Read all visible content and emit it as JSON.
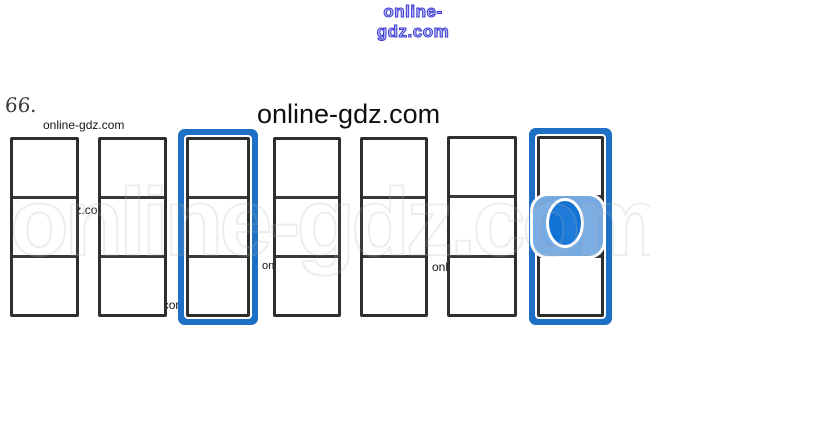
{
  "exercise": {
    "number": "66."
  },
  "title": {
    "text": "online-gdz.com"
  },
  "watermarks": {
    "top_text": "online-gdz.com",
    "small_text": "online-gdz.com",
    "ghost_text": "online-gdz.com"
  },
  "cards": {
    "count": 7,
    "cells_per_card": 3,
    "items": [
      {
        "id": 1,
        "highlighted": false,
        "cells": [
          "empty",
          "empty",
          "empty"
        ]
      },
      {
        "id": 2,
        "highlighted": false,
        "cells": [
          "empty",
          "empty",
          "empty"
        ]
      },
      {
        "id": 3,
        "highlighted": true,
        "cells": [
          "empty",
          "empty",
          "empty"
        ]
      },
      {
        "id": 4,
        "highlighted": false,
        "cells": [
          "empty",
          "empty",
          "empty"
        ]
      },
      {
        "id": 5,
        "highlighted": false,
        "cells": [
          "empty",
          "empty",
          "empty"
        ]
      },
      {
        "id": 6,
        "highlighted": false,
        "cells": [
          "empty",
          "empty",
          "empty"
        ]
      },
      {
        "id": 7,
        "highlighted": true,
        "cells": [
          "empty",
          "filled",
          "empty"
        ]
      }
    ],
    "colors": {
      "frame": "#2e2e2e",
      "highlight": "#1d70c4",
      "filled_cell": "#1b64b0",
      "ghost_square": "#74a9e2",
      "ghost_oval": "#1173d6"
    }
  }
}
